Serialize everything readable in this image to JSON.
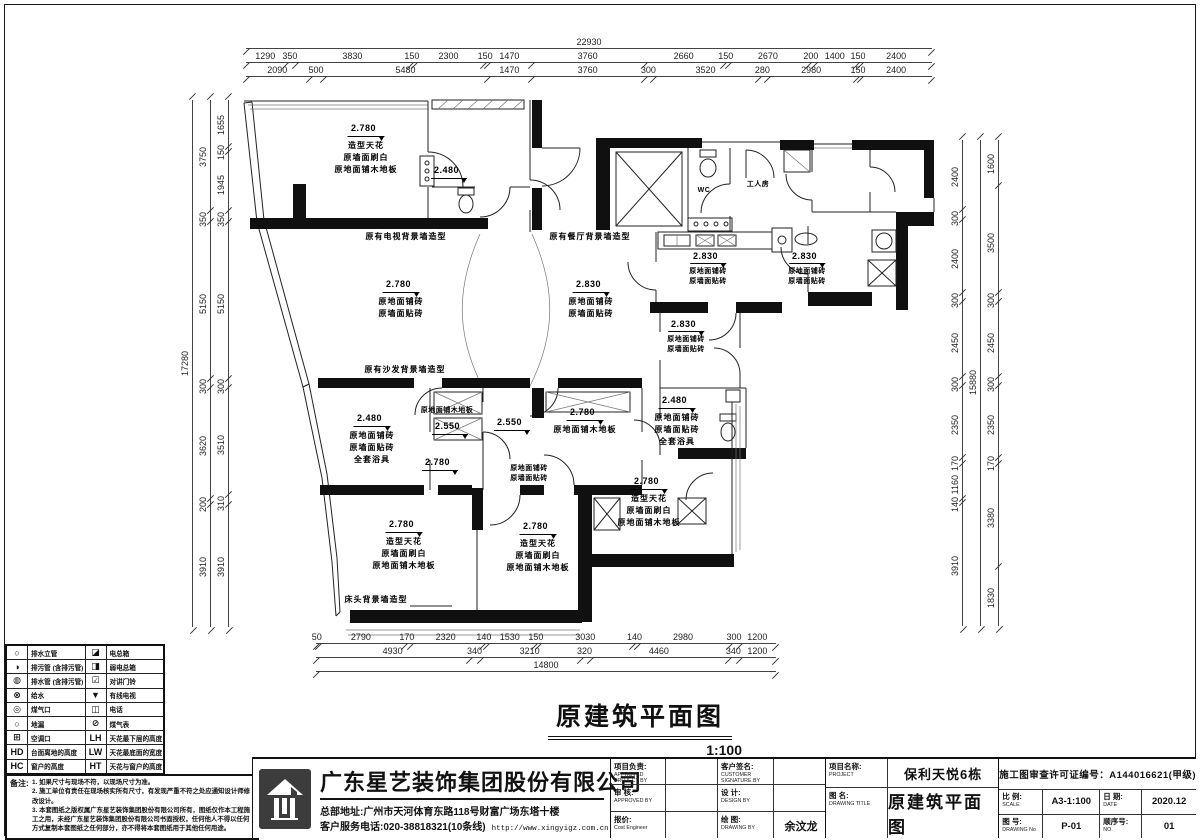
{
  "sheet": {
    "plan_title": "原建筑平面图",
    "plan_scale": "1:100"
  },
  "dimensions": {
    "top": {
      "overall": "22930",
      "row1": [
        "1290",
        "350",
        "3830",
        "150",
        "2300",
        "150",
        "1470",
        "3760",
        "2660",
        "150",
        "2670",
        "200",
        "1400",
        "150",
        "2400"
      ],
      "row2": [
        "2090",
        "500",
        "5480",
        "1470",
        "3760",
        "300",
        "3520",
        "280",
        "2980",
        "150",
        "2400"
      ]
    },
    "bottom": {
      "overall": "14800",
      "row1": [
        "50",
        "2790",
        "170",
        "2320",
        "140",
        "1530",
        "150",
        "3030",
        "140",
        "2980",
        "300",
        "1200"
      ],
      "row2": [
        "4930",
        "340",
        "3210",
        "320",
        "4460",
        "340",
        "1200"
      ]
    },
    "left": {
      "overall": "17280",
      "mid": [
        "3750",
        "350",
        "5150",
        "300",
        "3620",
        "200",
        "3910"
      ],
      "inner": [
        "1655",
        "150",
        "1945",
        "350",
        "5150",
        "300",
        "3510",
        "310",
        "3910"
      ]
    },
    "right": {
      "overall": "15880",
      "inner": [
        "2400",
        "300",
        "2400",
        "300",
        "2450",
        "300",
        "2350",
        "170",
        "1160",
        "140",
        "3910"
      ],
      "outer": [
        "1600",
        "3500",
        "300",
        "2450",
        "300",
        "2350",
        "170",
        "3380",
        "1830"
      ]
    }
  },
  "plan": {
    "annotations": [
      {
        "x": 186,
        "y": 30,
        "elev": "2.780",
        "lines": [
          "造型天花",
          "原墙面刷白",
          "原地面铺木地板"
        ]
      },
      {
        "x": 269,
        "y": 72,
        "elev": "2.480",
        "lines": []
      },
      {
        "x": 226,
        "y": 139,
        "lines": [
          "原有电视背景墙造型"
        ]
      },
      {
        "x": 410,
        "y": 139,
        "lines": [
          "原有餐厅背景墙造型"
        ]
      },
      {
        "x": 221,
        "y": 186,
        "elev": "2.780",
        "lines": [
          "原地面铺砖",
          "原墙面贴砖"
        ]
      },
      {
        "x": 411,
        "y": 186,
        "elev": "2.830",
        "lines": [
          "原地面铺砖",
          "原墙面贴砖"
        ]
      },
      {
        "x": 528,
        "y": 158,
        "elev": "2.830",
        "lines": [
          "原地面铺砖",
          "原墙面贴砖"
        ],
        "small": true
      },
      {
        "x": 627,
        "y": 158,
        "elev": "2.830",
        "lines": [
          "原地面铺砖",
          "原墙面贴砖"
        ],
        "small": true
      },
      {
        "x": 506,
        "y": 226,
        "elev": "2.830",
        "lines": [
          "原地面铺砖",
          "原墙面贴砖"
        ],
        "small": true
      },
      {
        "x": 578,
        "y": 88,
        "lines": [
          "工人房"
        ],
        "small": true
      },
      {
        "x": 524,
        "y": 94,
        "lines": [
          "WC"
        ],
        "small": true
      },
      {
        "x": 192,
        "y": 320,
        "elev": "2.480",
        "lines": [
          "原地面铺砖",
          "原墙面贴砖",
          "全套浴具"
        ]
      },
      {
        "x": 267,
        "y": 314,
        "lines": [
          "原地面铺木地板"
        ],
        "small": true
      },
      {
        "x": 270,
        "y": 328,
        "elev": "2.550",
        "lines": []
      },
      {
        "x": 332,
        "y": 324,
        "elev": "2.550",
        "lines": []
      },
      {
        "x": 260,
        "y": 364,
        "elev": "2.780",
        "lines": []
      },
      {
        "x": 349,
        "y": 372,
        "lines": [
          "原地面铺砖",
          "原墙面贴砖"
        ],
        "small": true
      },
      {
        "x": 405,
        "y": 314,
        "elev": "2.780",
        "lines": [
          "原地面铺木地板"
        ]
      },
      {
        "x": 497,
        "y": 302,
        "elev": "2.480",
        "lines": [
          "原地面铺砖",
          "原墙面贴砖",
          "全套浴具"
        ]
      },
      {
        "x": 469,
        "y": 383,
        "elev": "2.780",
        "lines": [
          "造型天花",
          "原墙面刷白",
          "原地面铺木地板"
        ]
      },
      {
        "x": 224,
        "y": 426,
        "elev": "2.780",
        "lines": [
          "造型天花",
          "原墙面刷白",
          "原地面铺木地板"
        ]
      },
      {
        "x": 358,
        "y": 428,
        "elev": "2.780",
        "lines": [
          "造型天花",
          "原墙面刷白",
          "原地面铺木地板"
        ]
      },
      {
        "x": 196,
        "y": 502,
        "lines": [
          "床头背景墙造型"
        ]
      },
      {
        "x": 225,
        "y": 272,
        "lines": [
          "原有沙发背景墙造型"
        ]
      }
    ]
  },
  "legend": {
    "rows": [
      {
        "sym1": "○",
        "label1": "排水立管",
        "sym2": "◪",
        "label2": "电总箱"
      },
      {
        "sym1": "◑",
        "label1": "排污管 (含排污管)",
        "sym2": "◨",
        "label2": "弱电总箱"
      },
      {
        "sym1": "◍",
        "label1": "排水管 (含排污管)",
        "sym2": "☑",
        "label2": "对讲门铃"
      },
      {
        "sym1": "⊗",
        "label1": "给水",
        "sym2": "▼",
        "label2": "有线电视"
      },
      {
        "sym1": "◎",
        "label1": "煤气口",
        "sym2": "◫",
        "label2": "电话"
      },
      {
        "sym1": "○",
        "label1": "地漏",
        "sym2": "⊘",
        "label2": "煤气表"
      },
      {
        "sym1": "⊞",
        "label1": "空调口",
        "sym2": "LH",
        "label2": "天花最下层的高度"
      },
      {
        "sym1": "HD",
        "label1": "台面离地的高度",
        "sym2": "LW",
        "label2": "天花最底面的宽度"
      },
      {
        "sym1": "HC",
        "label1": "窗户的高度",
        "sym2": "HT",
        "label2": "天花与窗户的高度"
      }
    ]
  },
  "notes": {
    "title": "备注:",
    "items": [
      "1. 如果尺寸与现场不符，以现场尺寸为准。",
      "2. 施工单位有责任在现场核实所有尺寸，有发现严重不符之处应通知设计师修改设计。",
      "3. 本套图纸之版权属广东星艺装饰集团股份有限公司所有，图纸仅作本工程施工之用，未经广东星艺装饰集团股份有限公司书面授权，任何他人不得以任何方式复制本套图纸之任何部分，亦不得将本套图纸用于其他任何用途。"
    ]
  },
  "titleblock": {
    "company": {
      "name": "广东星艺装饰集团股份有限公司",
      "address": "总部地址:广州市天河体育东路118号财富广场东塔十楼",
      "phone": "客户服务电话:020-38818321(10条线)",
      "website": "http://www.xingyigz.com.cn"
    },
    "fields": {
      "f1_cn": "项目负责:",
      "f1_en": "APPROVED PROJECT BY",
      "f1_val": "",
      "f2_cn": "客户签名:",
      "f2_en": "CUSTOMER SIGNATURE BY",
      "f2_val": "",
      "f3_cn": "审 核:",
      "f3_en": "APPROVED BY",
      "f3_val": "",
      "f4_cn": "设 计:",
      "f4_en": "DESIGN BY",
      "f4_val": "",
      "f5_cn": "报价:",
      "f5_en": "Cost Engineer",
      "f5_val": "",
      "f6_cn": "绘 图:",
      "f6_en": "DRAWING BY",
      "f6_val": "余汶龙"
    },
    "project_label_cn": "项目名称:",
    "project_label_en": "PROJECT",
    "project_value": "保利天悦6栋",
    "drawing_label_cn": "图 名:",
    "drawing_label_en": "DRAWING TITLE",
    "drawing_value": "原建筑平面图",
    "permit": "施工图审查许可证编号：A144016621(甲级)",
    "scale_label_cn": "比 例:",
    "scale_label_en": "SCALE",
    "scale_value": "A3-1:100",
    "date_label_cn": "日 期:",
    "date_label_en": "DATE",
    "date_value": "2020.12",
    "no_label_cn": "图 号:",
    "no_label_en": "DRAWING No",
    "no_value": "P-01",
    "seq_label_cn": "顺序号:",
    "seq_label_en": "NO.",
    "seq_value": "01"
  }
}
